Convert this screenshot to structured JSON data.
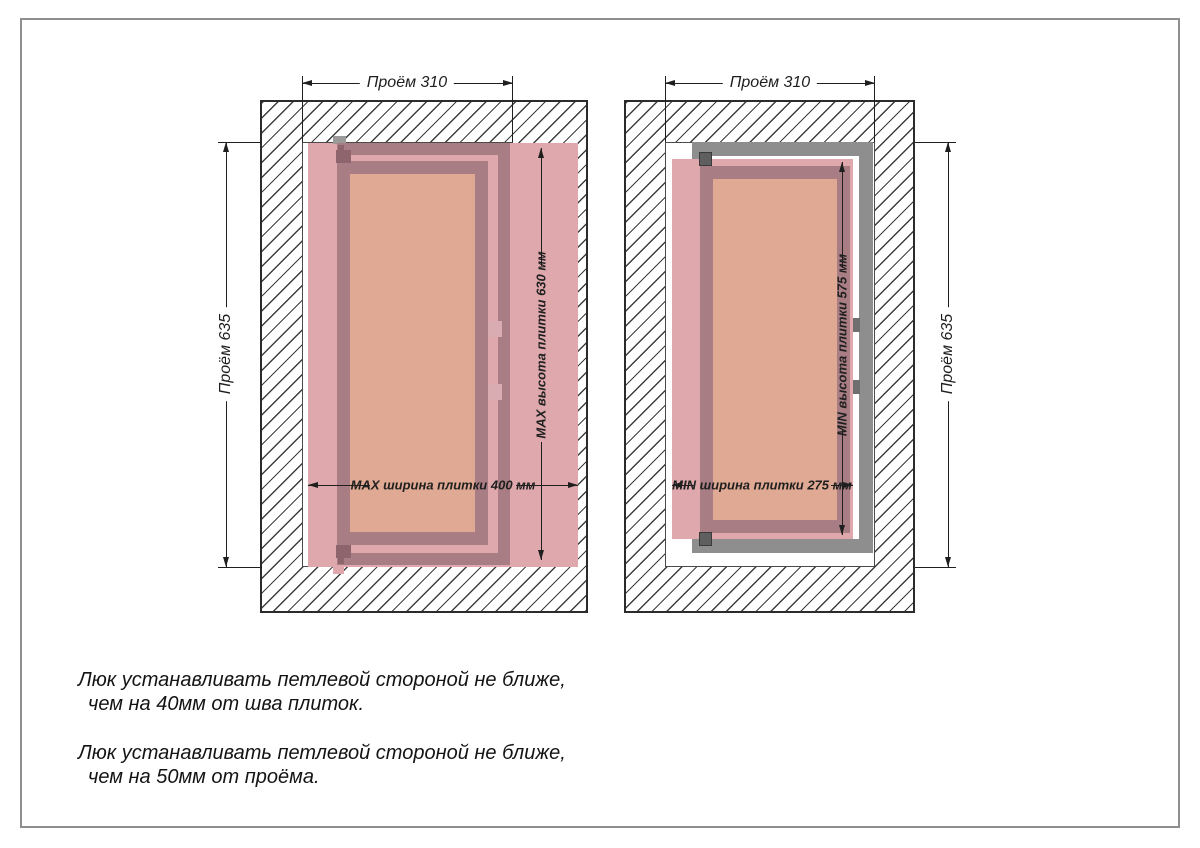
{
  "page": {
    "background": "#ffffff",
    "border_color": "#8f8f8f"
  },
  "colors": {
    "tile_pink": "#dfa8ac",
    "frame_mauve": "#a87e84",
    "door_salmon": "#dfa993",
    "metal_frame_gray": "#8e8e8e",
    "hinge_gray": "#5f5f5f",
    "hatch_line": "#3d3d3d",
    "dimension_line": "#1f1f1f"
  },
  "left_drawing": {
    "dim_opening_width": "Проём 310",
    "dim_opening_height": "Проём 635",
    "dim_tile_width": "MAX ширина плитки 400 мм",
    "dim_tile_height": "MAX высота плитки 630 мм"
  },
  "right_drawing": {
    "dim_opening_width": "Проём 310",
    "dim_opening_height": "Проём 635",
    "dim_tile_width": "MIN ширина плитки 275 мм",
    "dim_tile_height": "MIN высота плитки 575 мм"
  },
  "notes": [
    {
      "line1": "Люк устанавливать петлевой стороной не ближе,",
      "line2": "чем на 40мм от шва плиток."
    },
    {
      "line1": "Люк устанавливать петлевой стороной не ближе,",
      "line2": "чем на 50мм от проёма."
    }
  ]
}
